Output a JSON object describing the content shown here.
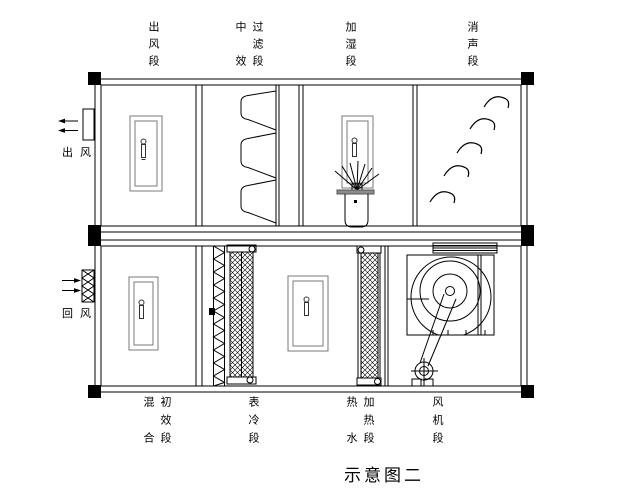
{
  "title": "示意图二",
  "airflow": {
    "supply_label": "出 风",
    "return_label": "回 风"
  },
  "top_sections": [
    {
      "label": "出风段",
      "cols": [
        "出风段"
      ]
    },
    {
      "label": "中效过滤段",
      "cols": [
        "中　效",
        "过滤段"
      ]
    },
    {
      "label": "加湿段",
      "cols": [
        "加湿段"
      ]
    },
    {
      "label": "消声段",
      "cols": [
        "消声段"
      ]
    }
  ],
  "bottom_sections": [
    {
      "label": "混合初效段",
      "cols": [
        "混　合",
        "初效段"
      ]
    },
    {
      "label": "表冷段",
      "cols": [
        "表冷段"
      ]
    },
    {
      "label": "热水加热段",
      "cols": [
        "热　水",
        "加热段"
      ]
    },
    {
      "label": "风机段",
      "cols": [
        "风机段"
      ]
    }
  ],
  "colors": {
    "line": "#000000",
    "background": "#ffffff",
    "door_outline": "#7a7a7a",
    "tray_fill": "#8c8c8c"
  }
}
